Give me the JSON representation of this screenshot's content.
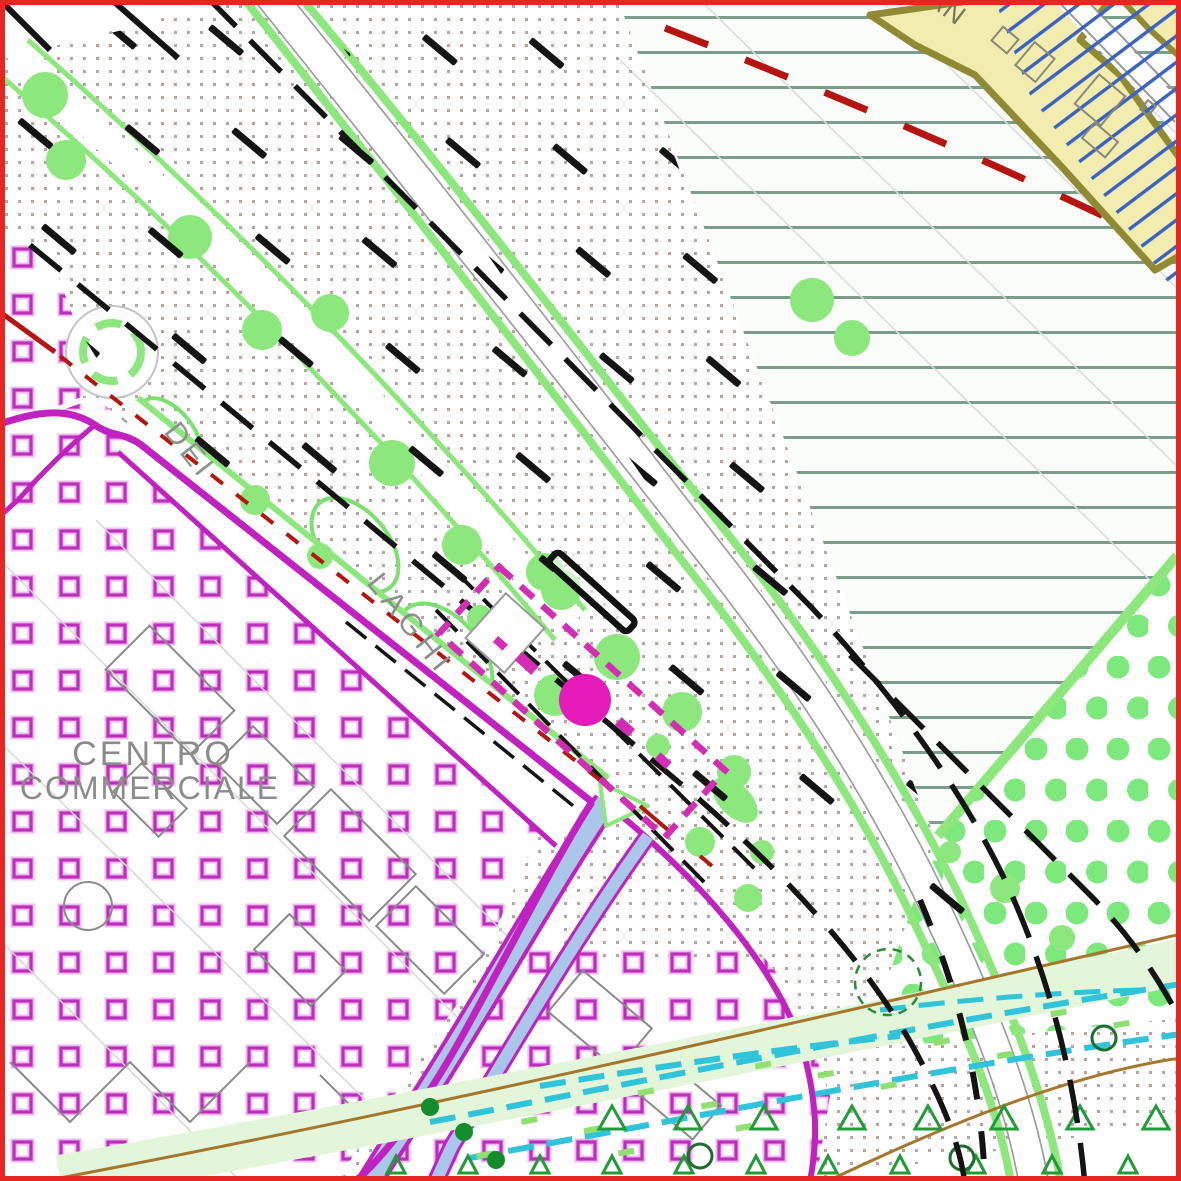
{
  "map": {
    "labels": {
      "zone_center_line1": "CENTRO",
      "zone_center_line2": "COMMERCIALE",
      "street_word_dei": "DEI",
      "street_word_laghi": "LAGHI",
      "top_right_fragment": "AN"
    },
    "palette": {
      "frame_red": "#e62621",
      "magenta_boundary": "#c021c0",
      "parcel_dash_magenta": "#d42cb4",
      "parcel_fill_magenta": "#e41ab9",
      "square_pattern_magenta": "#bb2fbb",
      "tree_green": "#8ce87c",
      "park_dot_green": "#7de87c",
      "dark_green": "#138c2c",
      "triangle_green": "#1f9c38",
      "hatch_line_green": "#7c9c8c",
      "dot_gray": "#b3a79f",
      "dash_black": "#141414",
      "red_dashed": "#b51410",
      "yellow_zone_fill": "#f2ecae",
      "yellow_zone_border": "#8f8a33",
      "blue_hatch": "#3a62c4",
      "cyan_canal": "#2fc4da",
      "road_blue_fill": "#aac6e8",
      "brown_line": "#a5772c",
      "building_gray": "#8a8a8a",
      "label_gray": "#8b8b8b"
    }
  }
}
